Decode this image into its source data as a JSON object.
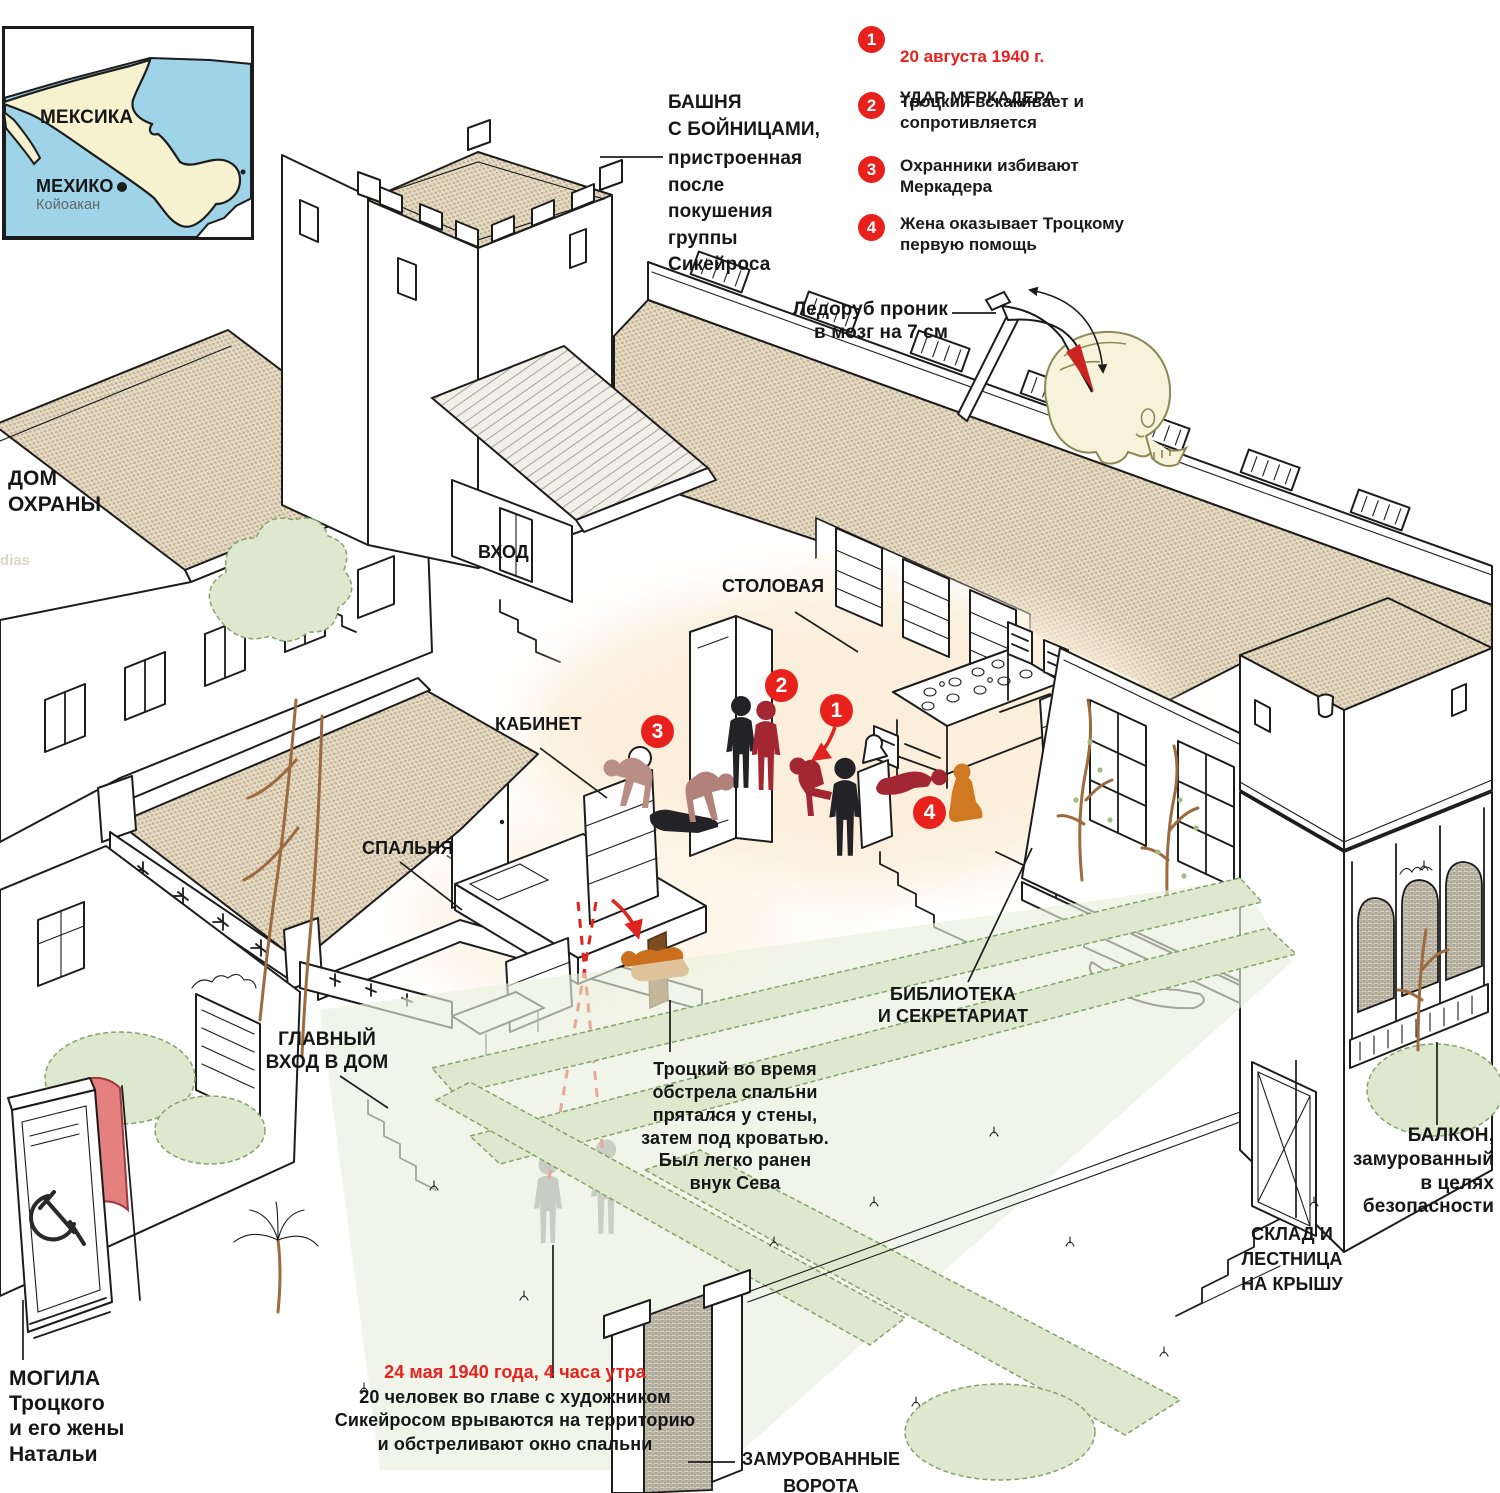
{
  "watermark": "dias",
  "map": {
    "country_label": "МЕКСИКА",
    "capital_label": "МЕХИКО",
    "district_label": "Койоакан"
  },
  "legend": {
    "items": [
      {
        "num": "1",
        "date": "20 августа 1940 г.",
        "text": "УДАР МЕРКАДЕРА."
      },
      {
        "num": "2",
        "text": "Троцкий вскакивает и\nсопротивляется"
      },
      {
        "num": "3",
        "text": "Охранники избивают\nМеркадера"
      },
      {
        "num": "4",
        "text": "Жена оказывает Троцкому\nпервую помощь"
      }
    ]
  },
  "icepick_note": "Ледоруб проник\nв мозг на 7 см",
  "labels": {
    "tower_bold": "БАШНЯ\nС БОЙНИЦАМИ,",
    "tower_rest": "пристроенная\nпосле\nпокушения\nгруппы\nСикейроса",
    "guard_house": "ДОМ\nОХРАНЫ",
    "entrance": "ВХОД",
    "dining": "СТОЛОВАЯ",
    "study": "КАБИНЕТ",
    "bedroom": "СПАЛЬНЯ",
    "main_entrance": "ГЛАВНЫЙ\nВХОД В ДОМ",
    "library": "БИБЛИОТЕКА\nИ СЕКРЕТАРИАТ",
    "hiding_note": "Троцкий во время\nобстрела спальни\nпрятался у стены,\nзатем под кроватью.\nБыл легко ранен\nвнук Сева",
    "grave": "МОГИЛА\nТроцкого\nи его жены\nНатальи",
    "raid_date": "24 мая 1940 года, 4 часа утра",
    "raid_text": "20 человек во главе с художником\nСикейросом врываются на территорию\nи обстреливают окно спальни",
    "gate": "ЗАМУРОВАННЫЕ\nВОРОТА",
    "storage": "СКЛАД И\nЛЕСТНИЦА\nНА КРЫШУ",
    "balcony": "БАЛКОН,\nзамурованный\nв целях\nбезопасности"
  },
  "colors": {
    "accent_red": "#e8211d",
    "roof_tan": "#d9cbae",
    "water_blue": "#9ed3e8",
    "land_yellow": "#f6f2cf",
    "hedge_green": "#dde8cf",
    "figure_black": "#232327",
    "figure_darkred": "#a32733",
    "figure_pink": "#b98e85",
    "figure_orange": "#cf7a23",
    "figure_gray": "#8b8e92"
  }
}
